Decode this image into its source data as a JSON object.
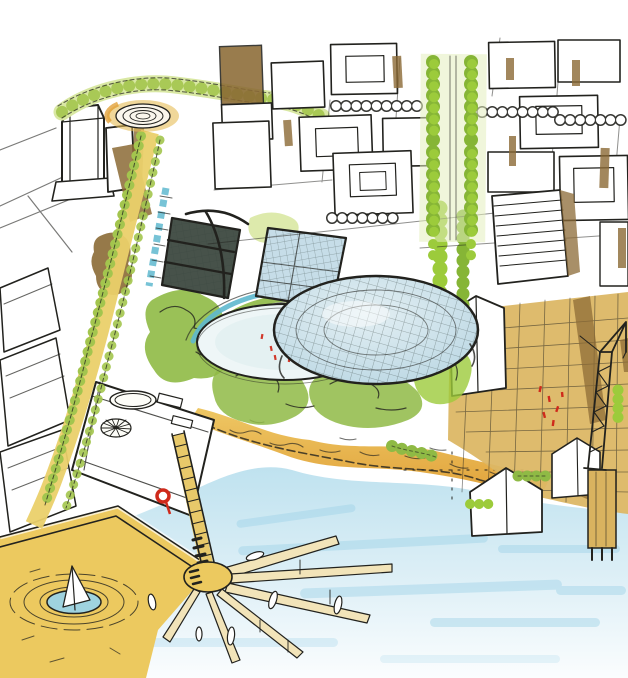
{
  "scene": {
    "description": "Hand-drawn aerial perspective sketch in ink and marker of a waterfront urban design concept: city blocks with a tree-lined boulevard, a circular plaza feeding a green promenade, mesh-domed glass pavilions beside an oval public plaza with tiny red figures, terraced gardens, a golden beach, a tan wharf with gabled sheds and a lattice crane, a yellow deck plaza with ripple rings and a sail pond, and a fan of finger piers reaching into pale blue water."
  },
  "palette": {
    "ink": "#22221e",
    "paper": "#ffffff",
    "treeBright": "#9ccb3b",
    "treeDeep": "#86b536",
    "treePale": "#d9e8a3",
    "treeMid": "#8fba45",
    "treeDark": "#5c7a2f",
    "hedge": "#a3c54e",
    "glow": "#e4efbe",
    "sandLight": "#eec764",
    "sandDeep": "#e09f37",
    "deckYellow": "#ecc95f",
    "wharfTan": "#dcb765",
    "promYellow": "#ead06a",
    "pierPale": "#f2e4b9",
    "waterLight": "#c4e4f0",
    "waterStreak": "#9fd3e8",
    "teal": "#5fb9cf",
    "poolBlue": "#9fd3df",
    "domeBlue": "#c6dde8",
    "plazaPale": "#eef6f7",
    "brown": "#8b6a35",
    "darkTent": "#2e3a31",
    "red": "#cf2a1b"
  },
  "elements": {
    "city_blocks": "downtown blocks",
    "boulevard": "tree-lined boulevard",
    "circle_plaza": "circular plaza",
    "promenade": "green promenade",
    "dome": "glass mesh dome",
    "canopy": "glass canopy",
    "dark_pavilion": "dark pavilion tent",
    "oval_plaza": "oval event plaza",
    "terraces": "terraced gardens",
    "beach": "sandy beach",
    "wharf": "harbor wharf",
    "crane": "harbor crane",
    "deck_plaza": "yellow deck plaza",
    "ripple_pond": "ripple-ring sail pond",
    "finger_pier": "fan finger pier",
    "water": "harbor water"
  }
}
